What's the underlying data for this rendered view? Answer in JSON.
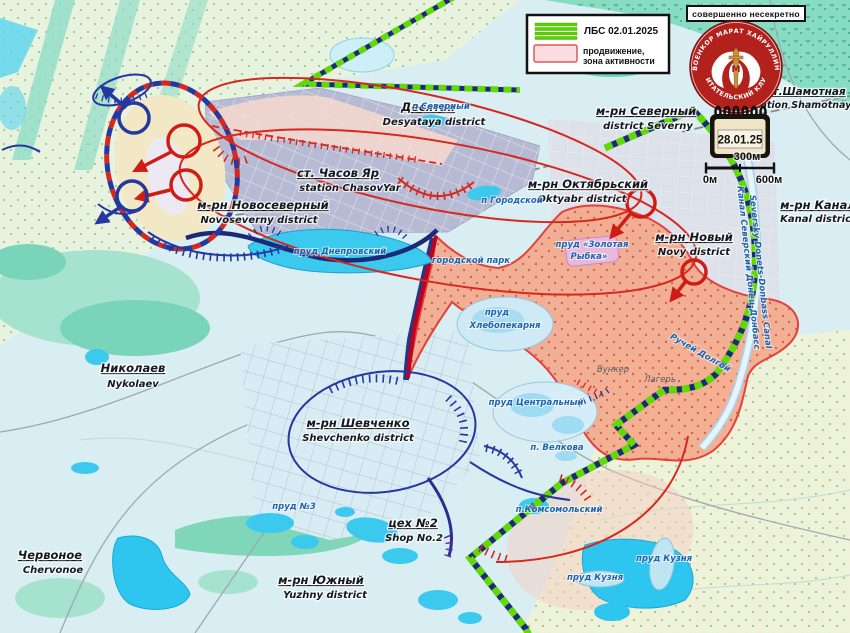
{
  "legend": {
    "lbs_label": "ЛБС 02.01.2025",
    "advance_line1": "продвижение,",
    "advance_line2": "зона активности"
  },
  "stamp_text": "совершенно несекретно",
  "emblem": {
    "top_text": "ВОЕНКОР МАРАТ ХАЙРУЛЛИН",
    "bottom_text": "ЧИТАТЕЛЬСКИЙ КЛУБ",
    "monogram": "М"
  },
  "date_badge": "28.01.25",
  "scale": {
    "zero": "0м",
    "mid": "300м",
    "max": "600м"
  },
  "districts": [
    {
      "ru": "Десятая",
      "en": "Desyataya district"
    },
    {
      "ru": "м-рн Северный",
      "en": "district Severny"
    },
    {
      "ru": "м-рн Новосеверный",
      "en": "Novoseverny district"
    },
    {
      "ru": "ст. Часов Яр",
      "en": "station ChasovYar"
    },
    {
      "ru": "м-рн Октябрьский",
      "en": "Oktyabr district"
    },
    {
      "ru": "м-рн Новый",
      "en": "Novy district"
    },
    {
      "ru": "м-рн Канал",
      "en": "Kanal district"
    },
    {
      "ru": "м-рн Шевченко",
      "en": "Shevchenko district"
    },
    {
      "ru": "цех №2",
      "en": "Shop No.2"
    },
    {
      "ru": "м-рн Южный",
      "en": "Yuzhny district"
    },
    {
      "ru": "Николаев",
      "en": "Nykolaev"
    },
    {
      "ru": "Червоное",
      "en": "Chervonoe"
    },
    {
      "ru": "ст.Шамотная",
      "en": "station Shamotnaya"
    }
  ],
  "water_labels": [
    "пруд Днепровский",
    "пруд",
    "Хлебопекарня",
    "пруд Центральный",
    "п. Велкова",
    "пруд «Золотая",
    "Рыбка»",
    "п Городской",
    "городской парк",
    "п.Комсомольский",
    "пруд №3",
    "пруд Кузня",
    "пруд Кузня",
    "п Северный",
    "Ручей Долгой",
    "Канал Северский Донец-Донбасс",
    "Seversky Donets-Donbass Canal"
  ],
  "site_labels": [
    "Бункер",
    "Лагерь"
  ],
  "colors": {
    "lbs_green": "#62d80a",
    "front_navy": "#1b2a78",
    "activity_fill": "#f4a98c",
    "activity_stroke": "#e2302a",
    "arrow_red": "#cf1d15",
    "arrow_blue": "#2438a0",
    "water_cyan": "#3cc9ee",
    "forest_teal": "#87dcc2",
    "emblem_red": "#b3211d"
  }
}
